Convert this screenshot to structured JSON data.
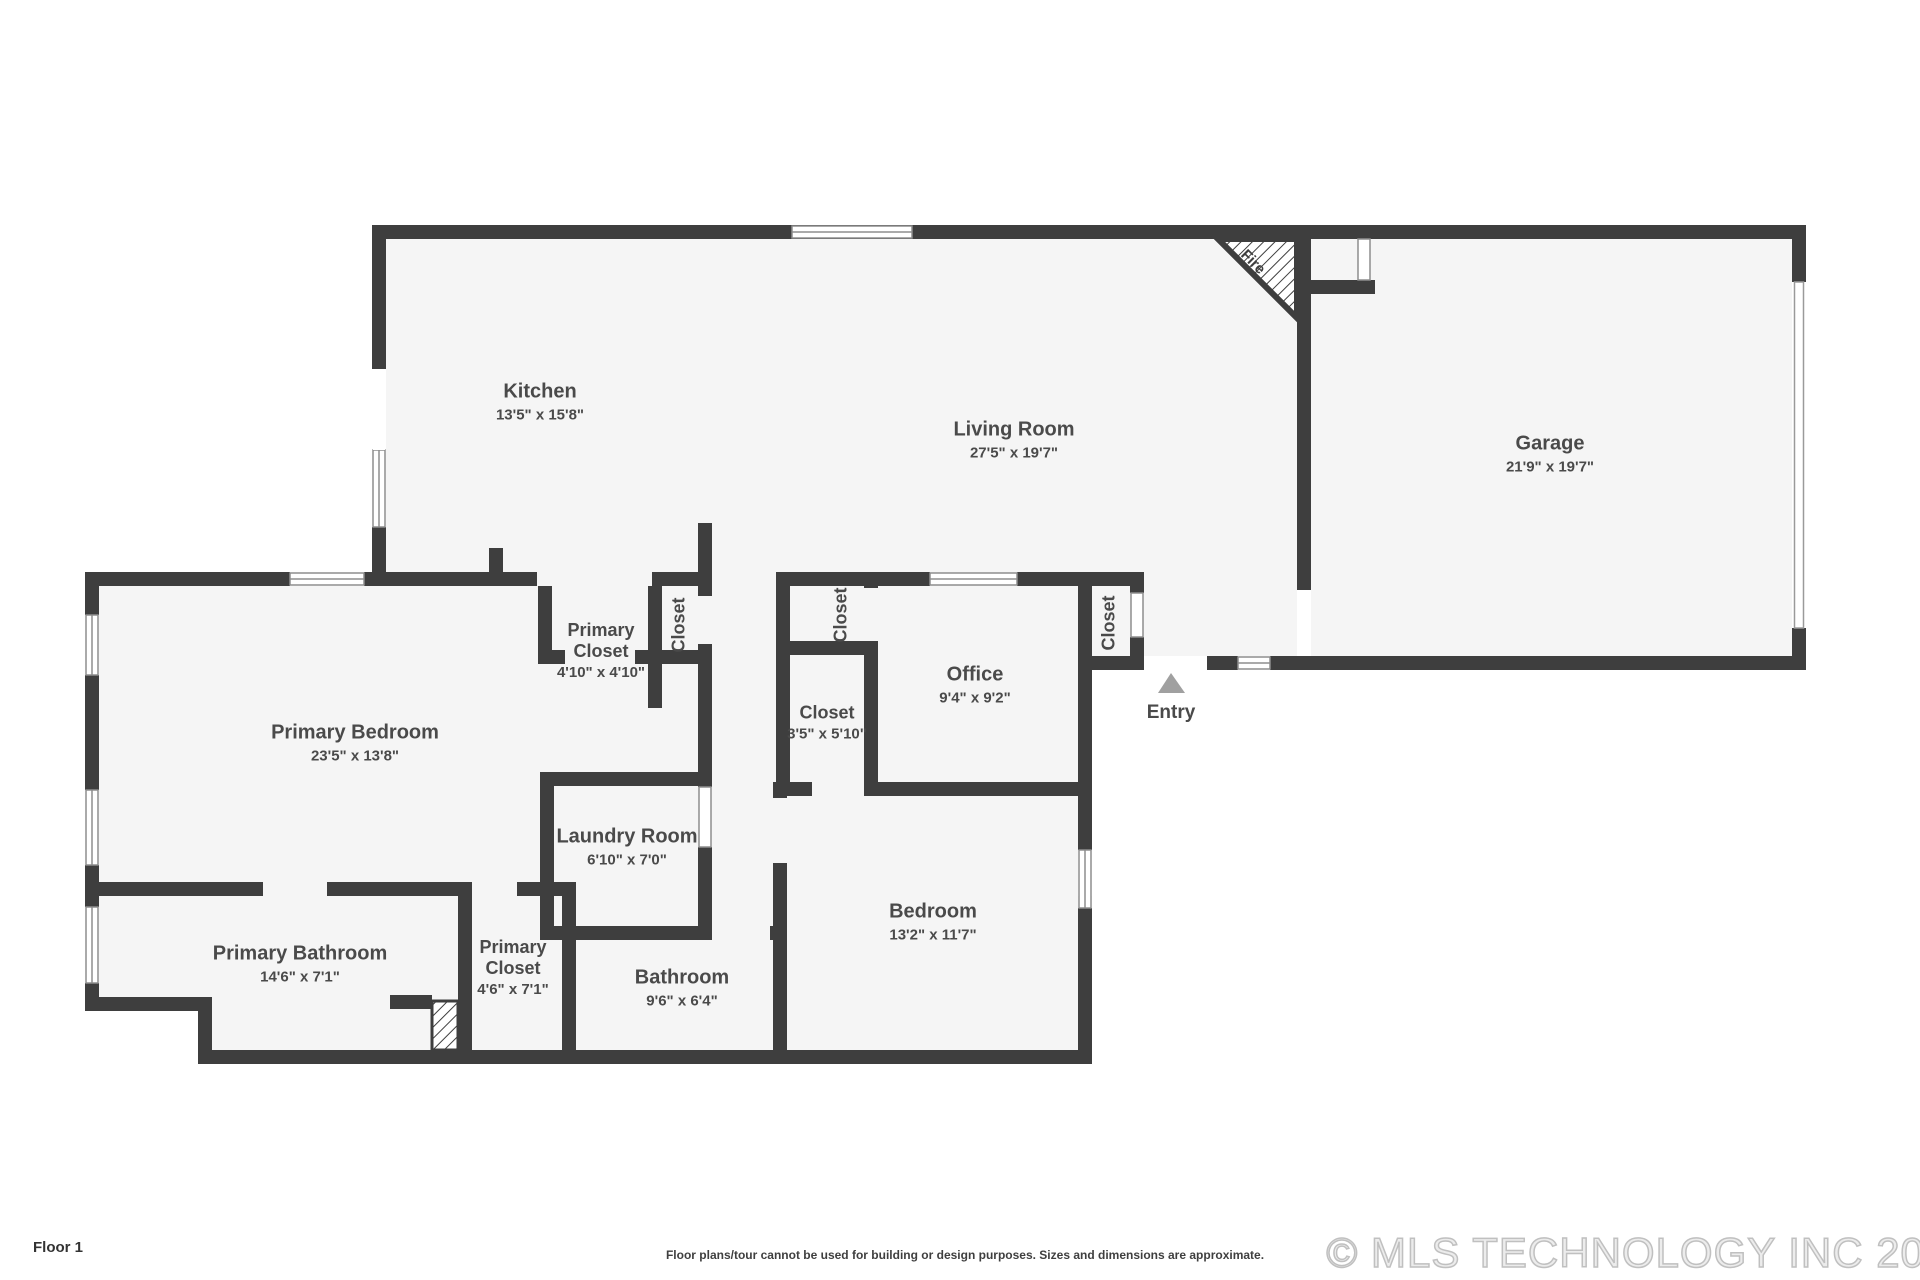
{
  "plan": {
    "entry_label": "Entry",
    "fireplace_label": "Fire"
  },
  "rooms": [
    {
      "id": "kitchen",
      "name": "Kitchen",
      "dims": "13'5\" x 15'8\""
    },
    {
      "id": "living-room",
      "name": "Living Room",
      "dims": "27'5\" x 19'7\""
    },
    {
      "id": "garage",
      "name": "Garage",
      "dims": "21'9\" x 19'7\""
    },
    {
      "id": "primary-bedroom",
      "name": "Primary Bedroom",
      "dims": "23'5\" x 13'8\""
    },
    {
      "id": "primary-closet-upper",
      "name": "Primary Closet",
      "dims": "4'10\" x 4'10\""
    },
    {
      "id": "closet-upper-small",
      "name": "Closet",
      "dims": ""
    },
    {
      "id": "closet-office",
      "name": "Closet",
      "dims": ""
    },
    {
      "id": "closet-hall",
      "name": "Closet",
      "dims": "3'5\" x 5'10\""
    },
    {
      "id": "office",
      "name": "Office",
      "dims": "9'4\" x 9'2\""
    },
    {
      "id": "closet-entry",
      "name": "Closet",
      "dims": ""
    },
    {
      "id": "laundry-room",
      "name": "Laundry Room",
      "dims": "6'10\" x 7'0\""
    },
    {
      "id": "bathroom",
      "name": "Bathroom",
      "dims": "9'6\" x 6'4\""
    },
    {
      "id": "primary-bathroom",
      "name": "Primary Bathroom",
      "dims": "14'6\" x 7'1\""
    },
    {
      "id": "primary-closet-lower",
      "name": "Primary Closet",
      "dims": "4'6\" x 7'1\""
    },
    {
      "id": "bedroom",
      "name": "Bedroom",
      "dims": "13'2\" x 11'7\""
    }
  ],
  "footer": {
    "floor_label": "Floor 1",
    "disclaimer": "Floor plans/tour cannot be used for building or design purposes. Sizes and dimensions are approximate.",
    "copyright": "© MLS TECHNOLOGY INC 2026"
  },
  "colors": {
    "wall": "#3e3e3e",
    "floor": "#f5f5f5",
    "window_frame": "#8d8d8d",
    "entry_arrow": "#a0a0a0",
    "copyright_gray": "#c0c0c0"
  }
}
